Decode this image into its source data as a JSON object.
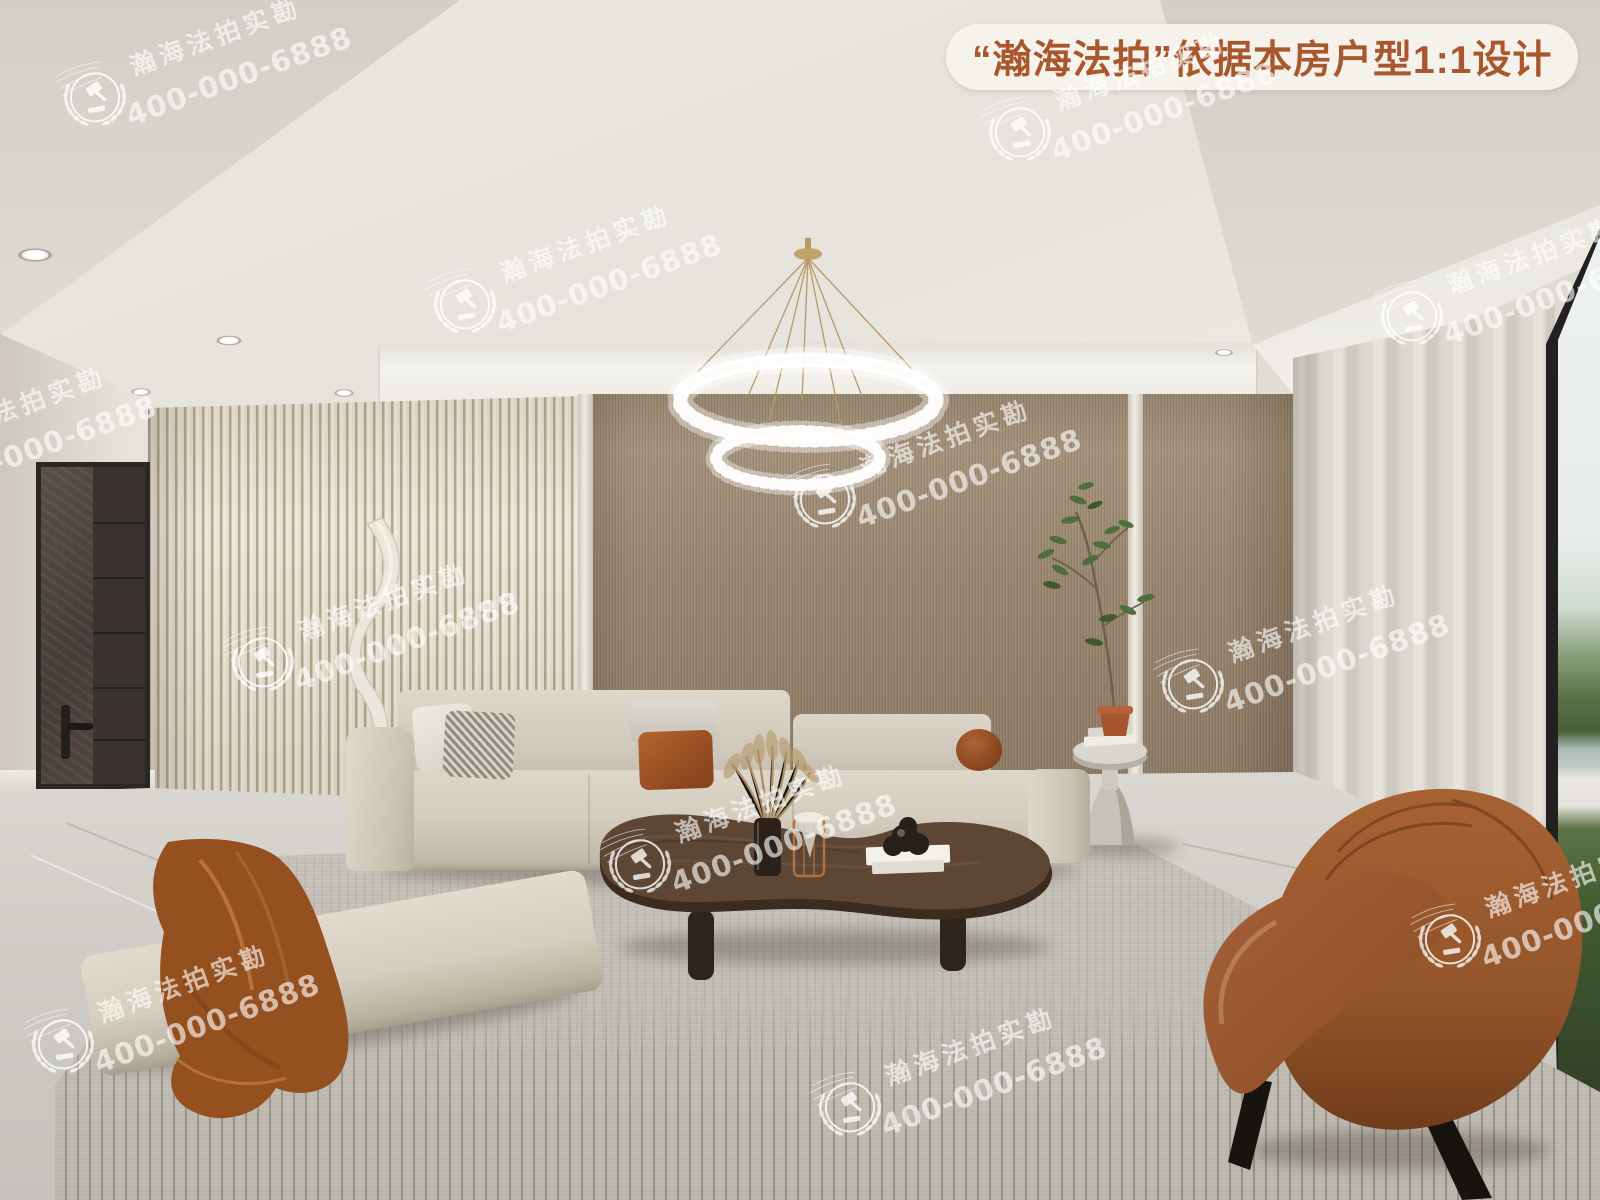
{
  "banner": {
    "text": "“瀚海法拍”依据本房户型1:1设计",
    "bg_color": "#f6f3ec",
    "text_color": "#a9582e"
  },
  "watermark": {
    "brand": "瀚海法拍实勘",
    "phone": "400-000-6888",
    "emblem": "laurel-gavel-badge",
    "color": "rgba(255,255,255,0.62)",
    "positions": [
      [
        95,
        93
      ],
      [
        1020,
        128
      ],
      [
        465,
        300
      ],
      [
        1412,
        312
      ],
      [
        825,
        495
      ],
      [
        263,
        658
      ],
      [
        1193,
        680
      ],
      [
        640,
        860
      ],
      [
        63,
        1040
      ],
      [
        850,
        1103
      ],
      [
        1450,
        935
      ],
      [
        -100,
        462
      ]
    ]
  },
  "scene": {
    "type": "interior-render-living-room",
    "palette": {
      "ceiling": "#e8e5df",
      "slat_wall_light": "#efeade",
      "slat_wall_dark": "#b2a791",
      "wood_wall": "#9a8771",
      "door": "#463e3a",
      "curtain": "#dcd8d0",
      "sofa": "#d6cfc2",
      "throw": "#94501f",
      "coffee_table": "#57402e",
      "armchair": "#9a5a2f",
      "rug": "#c6c2b9",
      "floor": "#d3d0ca",
      "chandelier_gold": "#c3a06c",
      "plant_green": "#4e6e3b",
      "window_view_sky": "#eef1f2",
      "window_view_trees": "#48613a",
      "window_view_water": "#aabab2"
    },
    "objects": [
      {
        "name": "crystal-ring-chandelier"
      },
      {
        "name": "recessed-downlights"
      },
      {
        "name": "entry-door"
      },
      {
        "name": "slat-accent-wall"
      },
      {
        "name": "wood-panel-wall"
      },
      {
        "name": "sculptural-floor-lamp"
      },
      {
        "name": "modular-sofa-with-chaise"
      },
      {
        "name": "silk-throw-blanket"
      },
      {
        "name": "kidney-coffee-table"
      },
      {
        "name": "pampas-vase"
      },
      {
        "name": "candle-holder"
      },
      {
        "name": "book-stack-and-sculpture"
      },
      {
        "name": "stone-side-table"
      },
      {
        "name": "potted-tree"
      },
      {
        "name": "velvet-accent-armchair"
      },
      {
        "name": "sheer-curtains"
      },
      {
        "name": "floor-to-ceiling-window"
      },
      {
        "name": "striped-area-rug"
      },
      {
        "name": "marble-floor"
      }
    ]
  }
}
